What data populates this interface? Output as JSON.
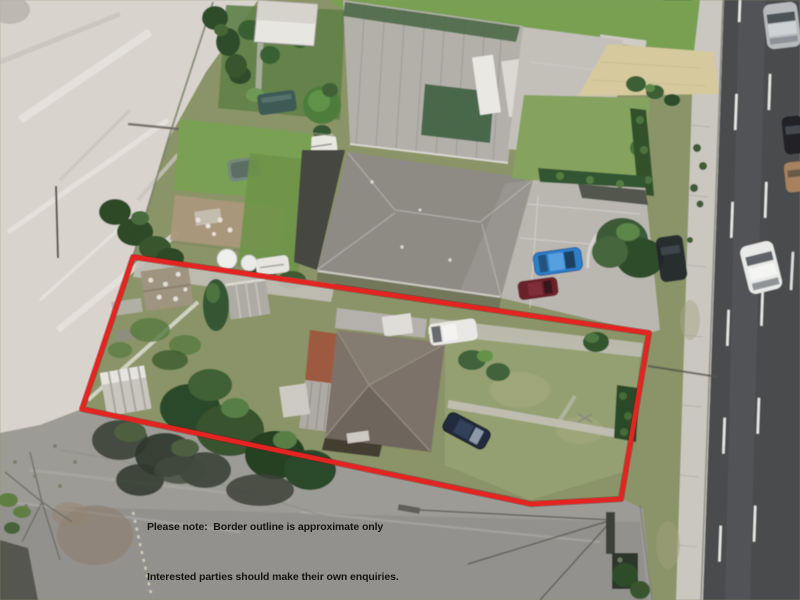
{
  "annotation": {
    "note_line1": "Please note:  Border outline is approximate only",
    "note_line2": "Interested parties should make their own enquiries.",
    "text_color": "#151515",
    "border_color": "#e32421",
    "border_meaning": "approximate property boundary outline"
  },
  "scene": {
    "type": "aerial-photo",
    "description": "Aerial photograph of a residential block with a red outline marking an approximate property boundary; vacant sandy ground on the left, asphalt parking at bottom, houses in the middle and a multi-lane road on the right",
    "features": {
      "sand_area": "vacant sandy ground",
      "parking_lot": "asphalt parking area with tree shadows",
      "road": "multi-lane road with dashed white lane lines",
      "footpath": "concrete footpath and grass verge",
      "outlined_property": "fenced lot with house, sheds, lawn and parked vehicles",
      "neighbour_house": "large dark hip-roof house",
      "top_house": "house with corrugated roof and white panels",
      "satellite_dishes": "two pairs of round white dishes",
      "vehicles": [
        "white van",
        "white ute",
        "dark blue car",
        "bright blue car",
        "maroon car",
        "white car",
        "silver car",
        "black SUV",
        "black car",
        "tan car"
      ]
    }
  }
}
